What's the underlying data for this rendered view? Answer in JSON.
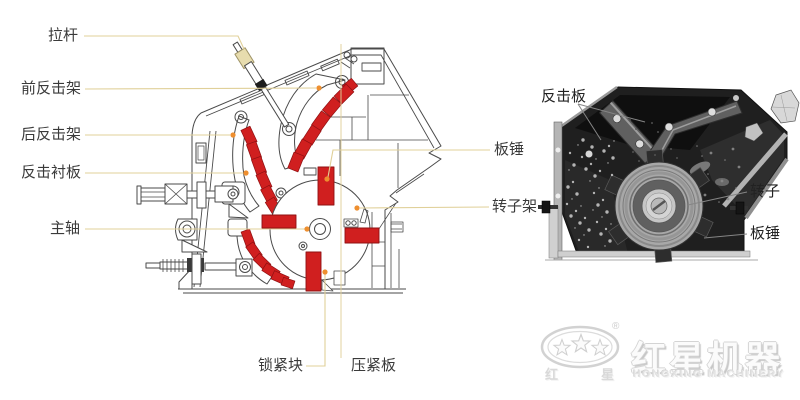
{
  "left_diagram": {
    "labels": {
      "tie_rod": "拉杆",
      "front_impact_frame": "前反击架",
      "rear_impact_frame": "后反击架",
      "impact_liner_plate": "反击衬板",
      "main_shaft": "主轴",
      "blow_bar": "板锤",
      "rotor_frame": "转子架",
      "locking_block": "锁紧块",
      "pressing_plate": "压紧板"
    }
  },
  "right_photo": {
    "labels": {
      "impact_plate": "反击板",
      "rotor": "转子",
      "blow_bar": "板锤"
    }
  },
  "logo": {
    "cn_small_left": "红",
    "cn_small_right": "星",
    "brand_cn": "红星机器",
    "brand_en": "HONGXING MACHINERY",
    "registered": "®"
  },
  "colors": {
    "highlight_red": "#d01f1f",
    "red_outline": "#8f1012",
    "leader_line": "#e0d099",
    "leader_dot": "#ee8f2f",
    "drawing_line": "#4a4a4a",
    "photo_dark": "#1f1f1f"
  }
}
